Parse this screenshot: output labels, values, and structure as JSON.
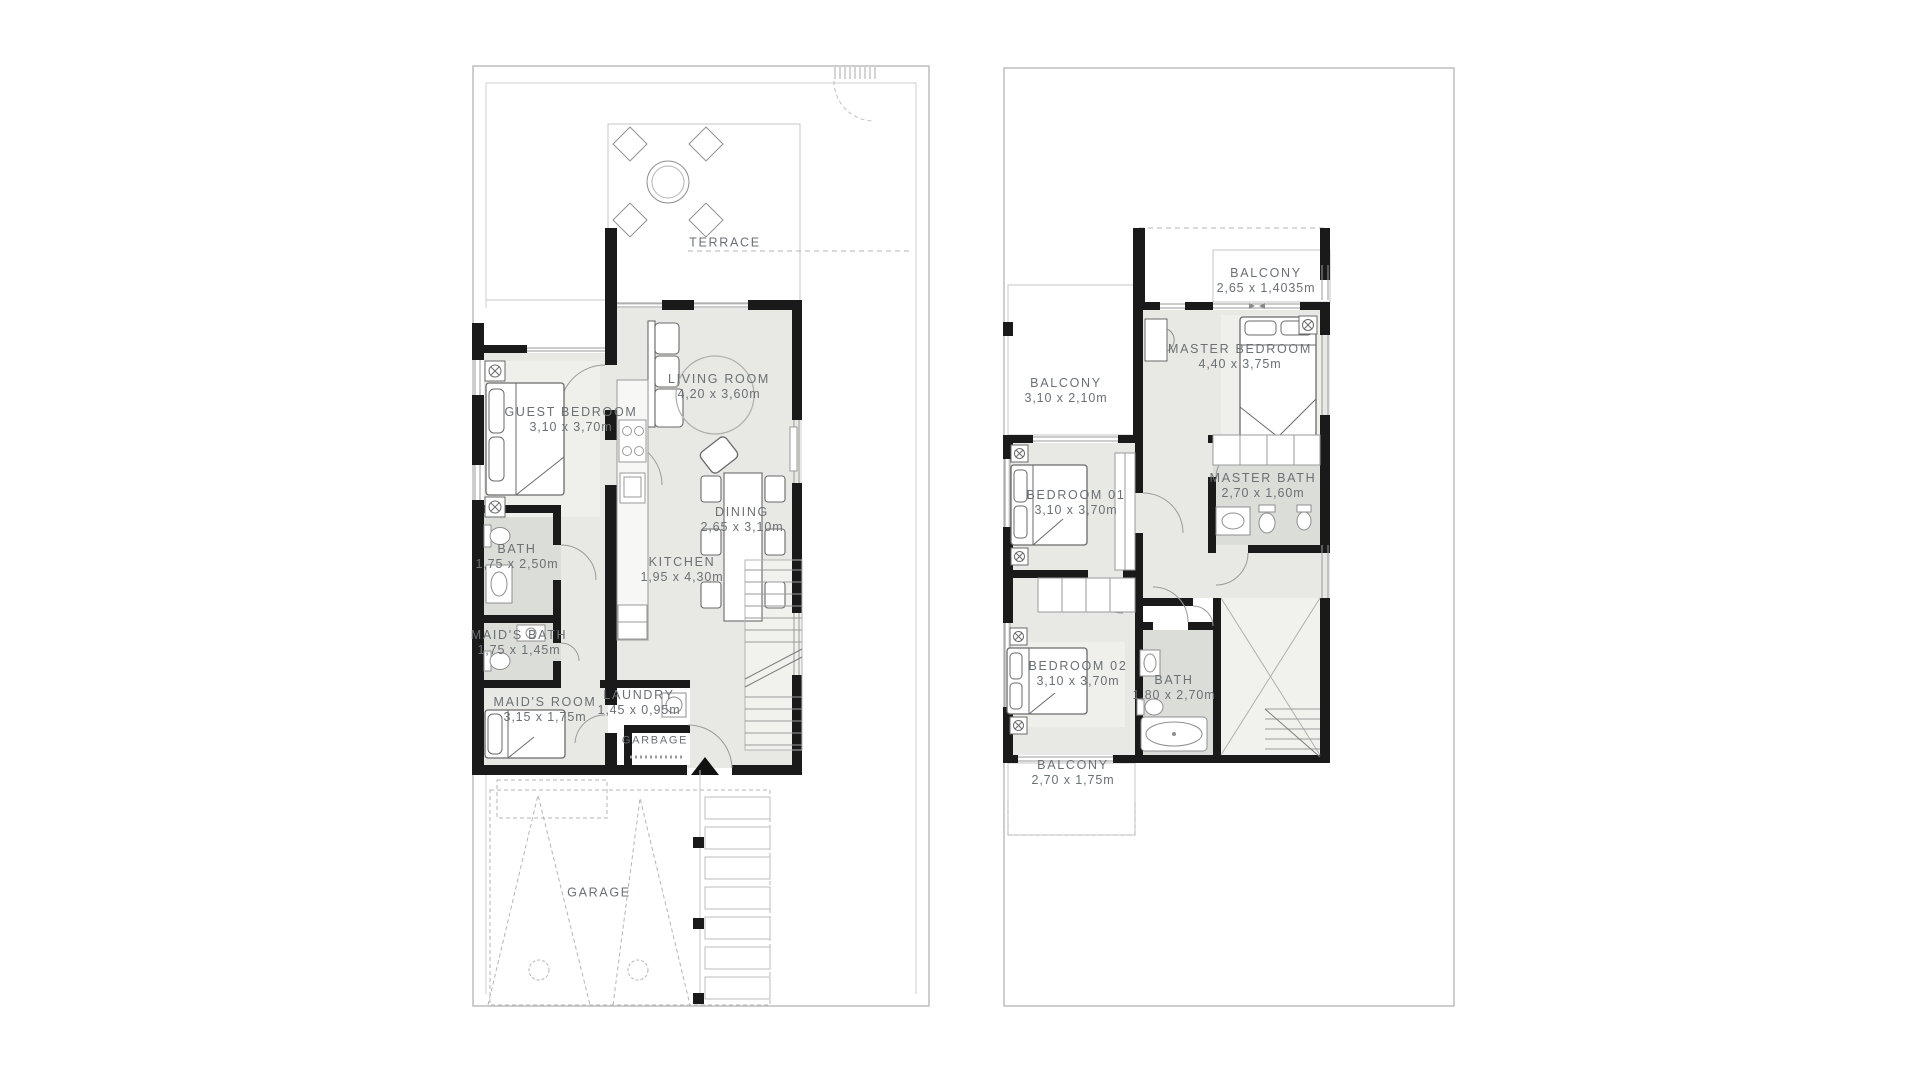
{
  "colors": {
    "wall": "#1a1a1a",
    "floor": "#e8e8e4",
    "floor_bath": "#dbddd8",
    "thin_line": "#9a9a9a",
    "boundary": "#b9b9b9",
    "label_text": "#6b7073",
    "background": "#ffffff"
  },
  "plans": [
    {
      "id": "ground-floor",
      "rooms": [
        {
          "name": "TERRACE",
          "dims": ""
        },
        {
          "name": "LIVING ROOM",
          "dims": "4,20 x 3,60m"
        },
        {
          "name": "GUEST BEDROOM",
          "dims": "3,10 x 3,70m"
        },
        {
          "name": "BATH",
          "dims": "1,75 x 2,50m"
        },
        {
          "name": "MAID'S BATH",
          "dims": "1,75 x 1,45m"
        },
        {
          "name": "MAID'S ROOM",
          "dims": "3,15 x 1,75m"
        },
        {
          "name": "LAUNDRY",
          "dims": "1,45 x 0,95m"
        },
        {
          "name": "GARBAGE",
          "dims": ""
        },
        {
          "name": "KITCHEN",
          "dims": "1,95 x 4,30m"
        },
        {
          "name": "DINING",
          "dims": "2,65 x 3,10m"
        },
        {
          "name": "GARAGE",
          "dims": ""
        }
      ]
    },
    {
      "id": "first-floor",
      "rooms": [
        {
          "name": "BALCONY",
          "dims": "2,65 x 1,4035m"
        },
        {
          "name": "MASTER BEDROOM",
          "dims": "4,40 x 3,75m"
        },
        {
          "name": "BALCONY",
          "dims": "3,10 x 2,10m"
        },
        {
          "name": "MASTER BATH",
          "dims": "2,70 x 1,60m"
        },
        {
          "name": "BEDROOM 01",
          "dims": "3,10 x 3,70m"
        },
        {
          "name": "BEDROOM 02",
          "dims": "3,10 x 3,70m"
        },
        {
          "name": "BATH",
          "dims": "1,80 x 2,70m"
        },
        {
          "name": "BALCONY",
          "dims": "2,70 x 1,75m"
        }
      ]
    }
  ]
}
